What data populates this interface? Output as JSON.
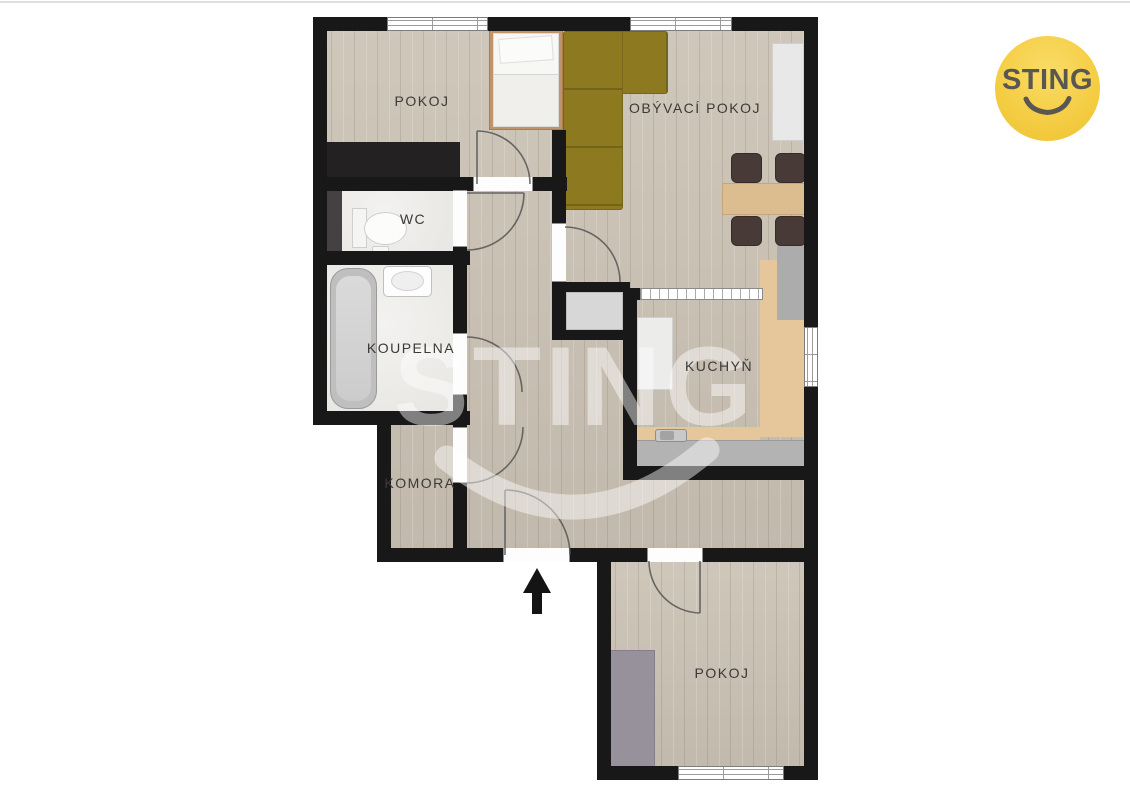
{
  "page": {
    "background": "#ffffff"
  },
  "floorplan": {
    "rooms": [
      {
        "id": "pokoj-top",
        "label": "POKOJ"
      },
      {
        "id": "obyvaci-pokoj",
        "label": "OBÝVACÍ POKOJ"
      },
      {
        "id": "wc",
        "label": "WC"
      },
      {
        "id": "koupelna",
        "label": "KOUPELNA"
      },
      {
        "id": "kuchyn",
        "label": "KUCHYŇ"
      },
      {
        "id": "komora",
        "label": "KOMORA"
      },
      {
        "id": "pokoj-bottom",
        "label": "POKOJ"
      }
    ],
    "entrance": {
      "direction": "up"
    },
    "watermark": {
      "text": "STING"
    },
    "colors": {
      "wall": "#181818",
      "floor_wood": "#c9c0b3",
      "floor_tile": "#e9e8e6",
      "sofa": "#8d7a20",
      "counter_wood": "#e5c79b",
      "counter_gray": "#b3b3b3",
      "table": "#dcbd8f"
    }
  },
  "branding": {
    "logo_text": "STING",
    "logo_background": "#f4cc42",
    "logo_foreground": "#5a5751"
  }
}
